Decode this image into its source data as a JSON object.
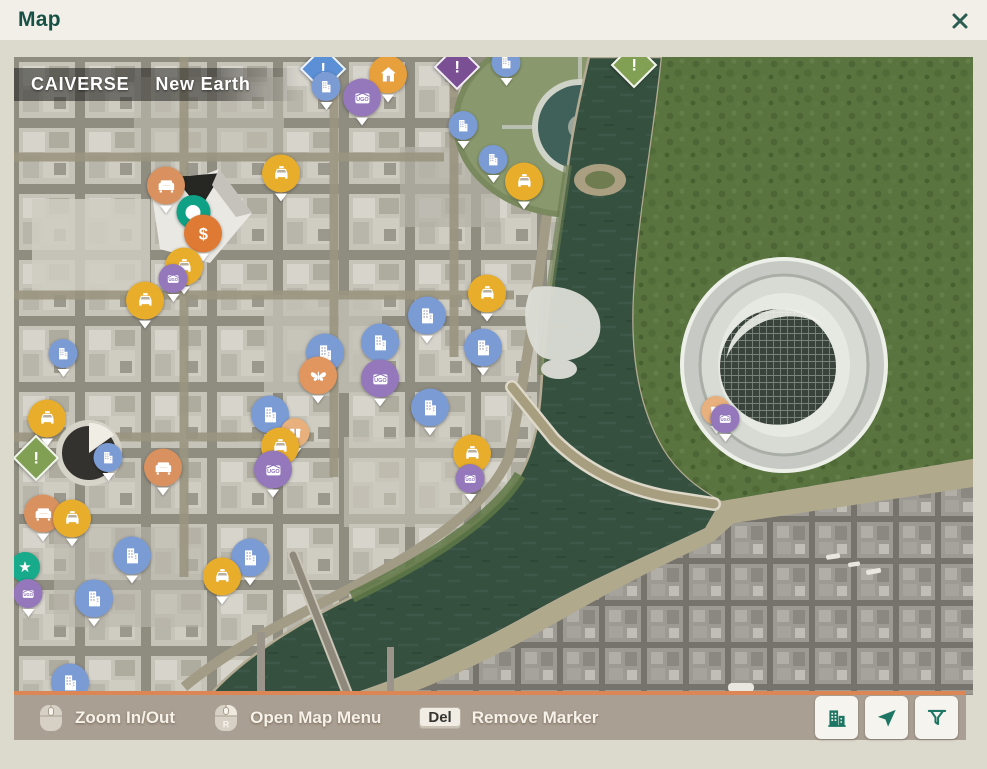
{
  "header": {
    "title": "Map"
  },
  "map_overlay": {
    "universe": "CAIVERSE",
    "world": "New Earth"
  },
  "toolbar": {
    "hints": [
      {
        "name": "zoom",
        "key": "scroll",
        "label": "Zoom In/Out"
      },
      {
        "name": "map-menu",
        "key": "R",
        "label": "Open Map Menu"
      },
      {
        "name": "remove-marker",
        "key": "Del",
        "label": "Remove Marker"
      }
    ],
    "buttons": [
      {
        "name": "buildings",
        "icon": "building-icon"
      },
      {
        "name": "locate",
        "icon": "navigation-arrow-icon"
      },
      {
        "name": "filter",
        "icon": "filter-icon"
      }
    ]
  },
  "colors": {
    "accent_teal": "#1d7563",
    "bar_orange": "#dd8655",
    "marker_taxi": "#e8ae2b",
    "marker_building": "#7b9bd4",
    "marker_ugo": "#9478bb",
    "marker_orange": "#df7a35",
    "player_teal": "#0fa186",
    "water": "#35503f",
    "forest": "#5a7440"
  },
  "markers": [
    {
      "type": "diamond-blue",
      "x": 309,
      "y": 12
    },
    {
      "type": "building",
      "x": 312,
      "y": 34,
      "small": true
    },
    {
      "type": "house",
      "x": 374,
      "y": 22
    },
    {
      "type": "ugo",
      "x": 348,
      "y": 45
    },
    {
      "type": "diamond-purple",
      "x": 443,
      "y": 10
    },
    {
      "type": "building",
      "x": 492,
      "y": 10,
      "small": true
    },
    {
      "type": "diamond-green",
      "x": 620,
      "y": 8
    },
    {
      "type": "building",
      "x": 449,
      "y": 73,
      "small": true
    },
    {
      "type": "building",
      "x": 479,
      "y": 107,
      "small": true
    },
    {
      "type": "taxi",
      "x": 510,
      "y": 129
    },
    {
      "type": "taxi",
      "x": 267,
      "y": 121
    },
    {
      "type": "sofa",
      "x": 152,
      "y": 133
    },
    {
      "type": "player",
      "x": 179,
      "y": 155
    },
    {
      "type": "dollar",
      "x": 189,
      "y": 181
    },
    {
      "type": "taxi",
      "x": 170,
      "y": 214
    },
    {
      "type": "ugo",
      "x": 159,
      "y": 226,
      "small": true
    },
    {
      "type": "taxi",
      "x": 131,
      "y": 248
    },
    {
      "type": "building",
      "x": 49,
      "y": 301,
      "small": true
    },
    {
      "type": "building",
      "x": 311,
      "y": 300
    },
    {
      "type": "butterfly",
      "x": 304,
      "y": 323
    },
    {
      "type": "taxi",
      "x": 473,
      "y": 241
    },
    {
      "type": "building",
      "x": 413,
      "y": 263
    },
    {
      "type": "building",
      "x": 366,
      "y": 290
    },
    {
      "type": "building",
      "x": 469,
      "y": 295
    },
    {
      "type": "ugo",
      "x": 366,
      "y": 326
    },
    {
      "type": "building",
      "x": 416,
      "y": 355
    },
    {
      "type": "building",
      "x": 256,
      "y": 362
    },
    {
      "type": "gift",
      "x": 281,
      "y": 380,
      "small": true
    },
    {
      "type": "taxi",
      "x": 266,
      "y": 394
    },
    {
      "type": "ugo",
      "x": 259,
      "y": 417
    },
    {
      "type": "building",
      "x": 94,
      "y": 405,
      "small": true
    },
    {
      "type": "sofa",
      "x": 149,
      "y": 415
    },
    {
      "type": "taxi",
      "x": 33,
      "y": 366
    },
    {
      "type": "diamond-green",
      "x": 22,
      "y": 401
    },
    {
      "type": "sofa",
      "x": 29,
      "y": 461
    },
    {
      "type": "taxi",
      "x": 58,
      "y": 466
    },
    {
      "type": "pin-star",
      "x": 11,
      "y": 518
    },
    {
      "type": "ugo",
      "x": 14,
      "y": 541,
      "small": true
    },
    {
      "type": "taxi",
      "x": 458,
      "y": 401
    },
    {
      "type": "ugo",
      "x": 456,
      "y": 426,
      "small": true
    },
    {
      "type": "building",
      "x": 118,
      "y": 503
    },
    {
      "type": "building",
      "x": 236,
      "y": 505
    },
    {
      "type": "taxi",
      "x": 208,
      "y": 524
    },
    {
      "type": "building",
      "x": 80,
      "y": 546
    },
    {
      "type": "building",
      "x": 56,
      "y": 630
    },
    {
      "type": "gift",
      "x": 702,
      "y": 358,
      "small": true
    },
    {
      "type": "ugo",
      "x": 711,
      "y": 366,
      "small": true
    }
  ]
}
